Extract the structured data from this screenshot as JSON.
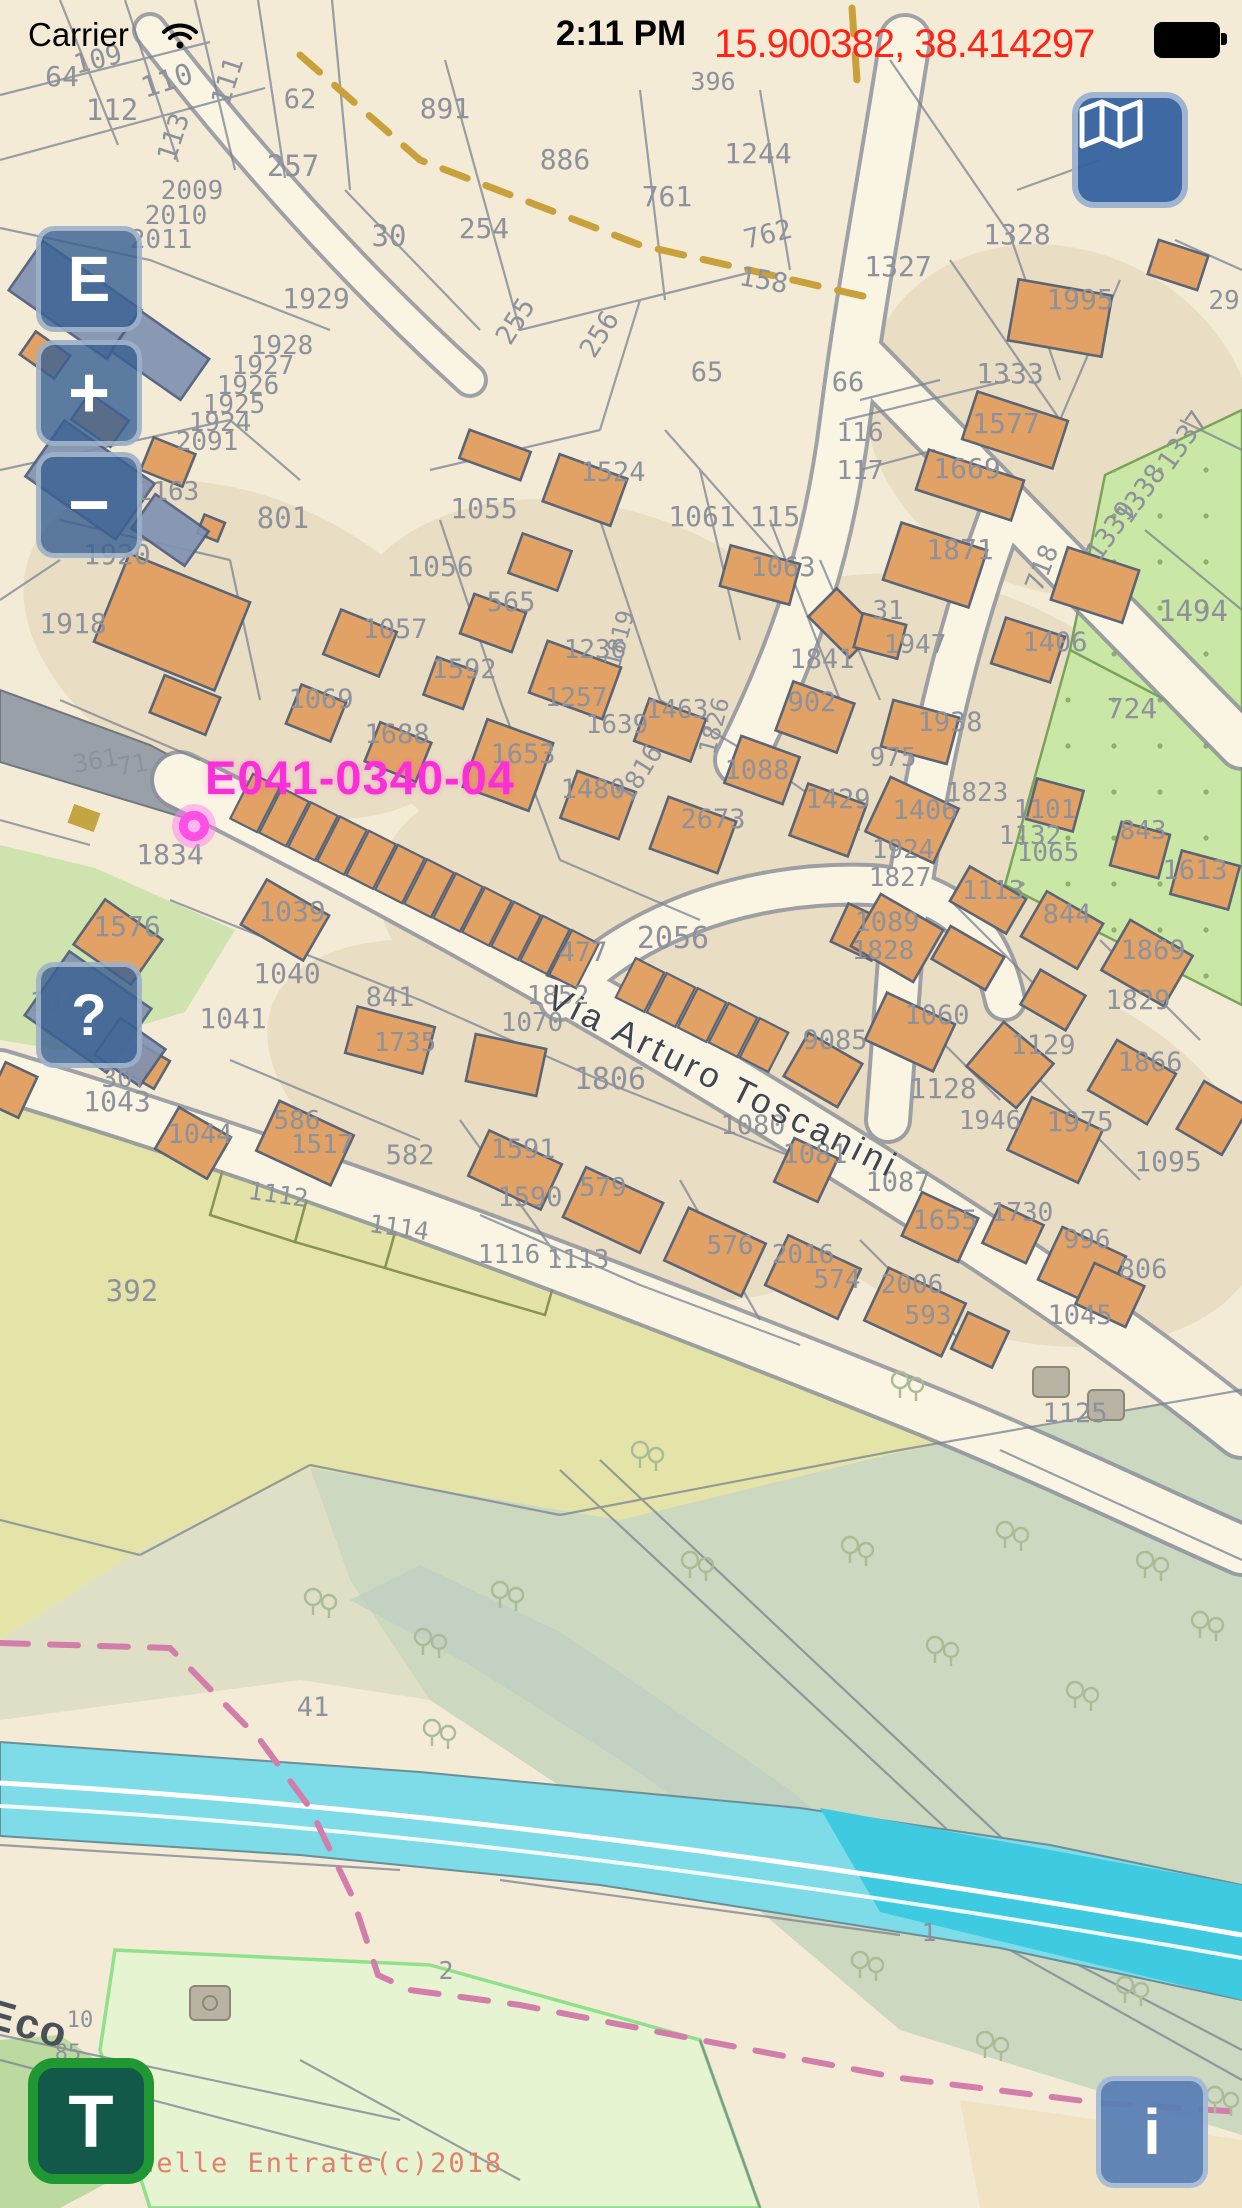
{
  "status_bar": {
    "carrier": "Carrier",
    "time": "2:11 PM"
  },
  "overlay": {
    "coordinates": "15.900382, 38.414297"
  },
  "controls": {
    "layers": {
      "name": "map-style"
    },
    "edit": {
      "label": "E"
    },
    "zoom_in": {
      "label": "+"
    },
    "zoom_out": {
      "label": "−"
    },
    "help": {
      "label": "?"
    },
    "track": {
      "label": "T"
    },
    "info": {
      "label": "i"
    }
  },
  "map": {
    "selected_parcel": "E041-0340-04",
    "street": "Via Arturo Toscanini",
    "road_label": "Eco",
    "copyright": "delle Entrate(c)2018",
    "labels": [
      {
        "t": "396",
        "x": 713,
        "y": 90,
        "s": 25
      },
      {
        "t": "64",
        "x": 62,
        "y": 86,
        "s": 28
      },
      {
        "t": "109",
        "x": 100,
        "y": 68,
        "s": 27,
        "r": -14
      },
      {
        "t": "110",
        "x": 170,
        "y": 90,
        "s": 29,
        "r": -18
      },
      {
        "t": "111",
        "x": 236,
        "y": 84,
        "s": 27,
        "r": -72
      },
      {
        "t": "112",
        "x": 112,
        "y": 120,
        "s": 29
      },
      {
        "t": "113",
        "x": 182,
        "y": 140,
        "s": 27,
        "r": -72
      },
      {
        "t": "62",
        "x": 300,
        "y": 108,
        "s": 27
      },
      {
        "t": "257",
        "x": 293,
        "y": 176,
        "s": 29
      },
      {
        "t": "30",
        "x": 389,
        "y": 246,
        "s": 29
      },
      {
        "t": "891",
        "x": 445,
        "y": 118,
        "s": 28
      },
      {
        "t": "886",
        "x": 565,
        "y": 169,
        "s": 28
      },
      {
        "t": "1244",
        "x": 758,
        "y": 163,
        "s": 28
      },
      {
        "t": "761",
        "x": 667,
        "y": 206,
        "s": 28
      },
      {
        "t": "762",
        "x": 770,
        "y": 243,
        "s": 27,
        "r": -14
      },
      {
        "t": "254",
        "x": 484,
        "y": 238,
        "s": 28
      },
      {
        "t": "255",
        "x": 523,
        "y": 326,
        "s": 27,
        "r": -58
      },
      {
        "t": "256",
        "x": 607,
        "y": 339,
        "s": 27,
        "r": -58
      },
      {
        "t": "158",
        "x": 762,
        "y": 289,
        "s": 27,
        "r": 10
      },
      {
        "t": "65",
        "x": 707,
        "y": 381,
        "s": 27
      },
      {
        "t": "66",
        "x": 848,
        "y": 391,
        "s": 27
      },
      {
        "t": "1328",
        "x": 1017,
        "y": 244,
        "s": 28
      },
      {
        "t": "1327",
        "x": 898,
        "y": 276,
        "s": 28
      },
      {
        "t": "1995",
        "x": 1080,
        "y": 309,
        "s": 28
      },
      {
        "t": "29",
        "x": 1224,
        "y": 309,
        "s": 26
      },
      {
        "t": "1333",
        "x": 1010,
        "y": 383,
        "s": 28
      },
      {
        "t": "1577",
        "x": 1006,
        "y": 433,
        "s": 28
      },
      {
        "t": "1669",
        "x": 967,
        "y": 478,
        "s": 28
      },
      {
        "t": "116",
        "x": 860,
        "y": 441,
        "s": 26
      },
      {
        "t": "117",
        "x": 860,
        "y": 479,
        "s": 26
      },
      {
        "t": "1337",
        "x": 1190,
        "y": 446,
        "s": 27,
        "r": -55
      },
      {
        "t": "1338",
        "x": 1148,
        "y": 499,
        "s": 27,
        "r": -55
      },
      {
        "t": "1339",
        "x": 1118,
        "y": 536,
        "s": 27,
        "r": -55
      },
      {
        "t": "2009",
        "x": 192,
        "y": 199,
        "s": 26
      },
      {
        "t": "2010",
        "x": 176,
        "y": 224,
        "s": 26
      },
      {
        "t": "2011",
        "x": 161,
        "y": 248,
        "s": 26
      },
      {
        "t": "1929",
        "x": 316,
        "y": 308,
        "s": 28
      },
      {
        "t": "1928",
        "x": 282,
        "y": 354,
        "s": 26
      },
      {
        "t": "1927",
        "x": 263,
        "y": 374,
        "s": 26
      },
      {
        "t": "1926",
        "x": 248,
        "y": 394,
        "s": 26
      },
      {
        "t": "1925",
        "x": 234,
        "y": 413,
        "s": 26
      },
      {
        "t": "1924",
        "x": 220,
        "y": 431,
        "s": 26
      },
      {
        "t": "2091",
        "x": 207,
        "y": 450,
        "s": 26
      },
      {
        "t": "1920",
        "x": 117,
        "y": 564,
        "s": 28
      },
      {
        "t": "1918",
        "x": 73,
        "y": 633,
        "s": 28
      },
      {
        "t": "801",
        "x": 283,
        "y": 528,
        "s": 29
      },
      {
        "t": "2163",
        "x": 168,
        "y": 500,
        "s": 26
      },
      {
        "t": "1057",
        "x": 395,
        "y": 638,
        "s": 27
      },
      {
        "t": "1069",
        "x": 321,
        "y": 708,
        "s": 27
      },
      {
        "t": "1688",
        "x": 397,
        "y": 743,
        "s": 27
      },
      {
        "t": "361",
        "x": 97,
        "y": 769,
        "s": 25,
        "r": -10
      },
      {
        "t": "71",
        "x": 134,
        "y": 773,
        "s": 25,
        "r": -10
      },
      {
        "t": "1834",
        "x": 170,
        "y": 864,
        "s": 28
      },
      {
        "t": "1524",
        "x": 613,
        "y": 481,
        "s": 27
      },
      {
        "t": "1055",
        "x": 484,
        "y": 518,
        "s": 28
      },
      {
        "t": "1056",
        "x": 440,
        "y": 576,
        "s": 28
      },
      {
        "t": "1061",
        "x": 702,
        "y": 526,
        "s": 28
      },
      {
        "t": "115",
        "x": 775,
        "y": 526,
        "s": 28
      },
      {
        "t": "1063",
        "x": 783,
        "y": 576,
        "s": 27
      },
      {
        "t": "565",
        "x": 511,
        "y": 611,
        "s": 27
      },
      {
        "t": "1592",
        "x": 464,
        "y": 678,
        "s": 27
      },
      {
        "t": "1236",
        "x": 595,
        "y": 658,
        "s": 26
      },
      {
        "t": "1257",
        "x": 576,
        "y": 706,
        "s": 26
      },
      {
        "t": "1639",
        "x": 617,
        "y": 733,
        "s": 26
      },
      {
        "t": "1463",
        "x": 677,
        "y": 718,
        "s": 26
      },
      {
        "t": "902",
        "x": 812,
        "y": 711,
        "s": 27
      },
      {
        "t": "1841",
        "x": 822,
        "y": 668,
        "s": 27
      },
      {
        "t": "1088",
        "x": 757,
        "y": 779,
        "s": 27
      },
      {
        "t": "1653",
        "x": 523,
        "y": 763,
        "s": 27
      },
      {
        "t": "1480",
        "x": 593,
        "y": 798,
        "s": 27
      },
      {
        "t": "1816",
        "x": 647,
        "y": 778,
        "s": 26,
        "r": -58
      },
      {
        "t": "1819",
        "x": 627,
        "y": 641,
        "s": 24,
        "r": -75
      },
      {
        "t": "1826",
        "x": 722,
        "y": 728,
        "s": 24,
        "r": -75
      },
      {
        "t": "1429",
        "x": 838,
        "y": 808,
        "s": 27
      },
      {
        "t": "2673",
        "x": 713,
        "y": 828,
        "s": 27
      },
      {
        "t": "1871",
        "x": 960,
        "y": 559,
        "s": 28
      },
      {
        "t": "718",
        "x": 1050,
        "y": 571,
        "s": 26,
        "r": -68
      },
      {
        "t": "1406",
        "x": 1055,
        "y": 651,
        "s": 27
      },
      {
        "t": "1494",
        "x": 1193,
        "y": 621,
        "s": 29
      },
      {
        "t": "724",
        "x": 1132,
        "y": 718,
        "s": 28
      },
      {
        "t": "31",
        "x": 888,
        "y": 619,
        "s": 26
      },
      {
        "t": "1947",
        "x": 915,
        "y": 653,
        "s": 26
      },
      {
        "t": "1938",
        "x": 950,
        "y": 731,
        "s": 27
      },
      {
        "t": "975",
        "x": 893,
        "y": 766,
        "s": 26
      },
      {
        "t": "1823",
        "x": 977,
        "y": 801,
        "s": 26
      },
      {
        "t": "1406",
        "x": 925,
        "y": 819,
        "s": 27
      },
      {
        "t": "1101",
        "x": 1045,
        "y": 818,
        "s": 26
      },
      {
        "t": "1132",
        "x": 1030,
        "y": 844,
        "s": 26
      },
      {
        "t": "1065",
        "x": 1048,
        "y": 861,
        "s": 26
      },
      {
        "t": "1924",
        "x": 903,
        "y": 858,
        "s": 26
      },
      {
        "t": "1827",
        "x": 900,
        "y": 886,
        "s": 26
      },
      {
        "t": "843",
        "x": 1143,
        "y": 839,
        "s": 26
      },
      {
        "t": "1613",
        "x": 1195,
        "y": 879,
        "s": 27
      },
      {
        "t": "1113",
        "x": 993,
        "y": 899,
        "s": 26
      },
      {
        "t": "1089",
        "x": 887,
        "y": 931,
        "s": 27
      },
      {
        "t": "1828",
        "x": 883,
        "y": 959,
        "s": 26
      },
      {
        "t": "844",
        "x": 1067,
        "y": 923,
        "s": 27
      },
      {
        "t": "1869",
        "x": 1153,
        "y": 959,
        "s": 27
      },
      {
        "t": "1829",
        "x": 1138,
        "y": 1009,
        "s": 27
      },
      {
        "t": "1060",
        "x": 937,
        "y": 1024,
        "s": 27
      },
      {
        "t": "1129",
        "x": 1043,
        "y": 1054,
        "s": 27
      },
      {
        "t": "1128",
        "x": 943,
        "y": 1098,
        "s": 28
      },
      {
        "t": "1866",
        "x": 1150,
        "y": 1071,
        "s": 27
      },
      {
        "t": "1946",
        "x": 990,
        "y": 1129,
        "s": 26
      },
      {
        "t": "1975",
        "x": 1080,
        "y": 1131,
        "s": 28
      },
      {
        "t": "1095",
        "x": 1168,
        "y": 1171,
        "s": 28
      },
      {
        "t": "1087",
        "x": 898,
        "y": 1191,
        "s": 27
      },
      {
        "t": "1655",
        "x": 945,
        "y": 1229,
        "s": 27
      },
      {
        "t": "1730",
        "x": 1022,
        "y": 1221,
        "s": 26
      },
      {
        "t": "996",
        "x": 1087,
        "y": 1248,
        "s": 26
      },
      {
        "t": "806",
        "x": 1143,
        "y": 1278,
        "s": 27
      },
      {
        "t": "2006",
        "x": 912,
        "y": 1293,
        "s": 26
      },
      {
        "t": "593",
        "x": 928,
        "y": 1324,
        "s": 26
      },
      {
        "t": "1045",
        "x": 1080,
        "y": 1324,
        "s": 27
      },
      {
        "t": "1125",
        "x": 1075,
        "y": 1422,
        "s": 27
      },
      {
        "t": "2056",
        "x": 673,
        "y": 948,
        "s": 30
      },
      {
        "t": "477",
        "x": 583,
        "y": 961,
        "s": 27
      },
      {
        "t": "1852",
        "x": 558,
        "y": 1004,
        "s": 26
      },
      {
        "t": "1070",
        "x": 532,
        "y": 1031,
        "s": 26
      },
      {
        "t": "1806",
        "x": 610,
        "y": 1089,
        "s": 30
      },
      {
        "t": "9085",
        "x": 835,
        "y": 1049,
        "s": 27
      },
      {
        "t": "1080",
        "x": 753,
        "y": 1134,
        "s": 27
      },
      {
        "t": "1081",
        "x": 815,
        "y": 1163,
        "s": 27
      },
      {
        "t": "1591",
        "x": 523,
        "y": 1158,
        "s": 27
      },
      {
        "t": "1590",
        "x": 530,
        "y": 1206,
        "s": 27
      },
      {
        "t": "579",
        "x": 603,
        "y": 1196,
        "s": 26
      },
      {
        "t": "576",
        "x": 730,
        "y": 1254,
        "s": 26
      },
      {
        "t": "574",
        "x": 837,
        "y": 1288,
        "s": 26
      },
      {
        "t": "1116",
        "x": 509,
        "y": 1263,
        "s": 26
      },
      {
        "t": "1113",
        "x": 578,
        "y": 1268,
        "s": 26
      },
      {
        "t": "2016",
        "x": 803,
        "y": 1263,
        "s": 26
      },
      {
        "t": "1576",
        "x": 127,
        "y": 936,
        "s": 28
      },
      {
        "t": "1039",
        "x": 292,
        "y": 921,
        "s": 28
      },
      {
        "t": "1040",
        "x": 287,
        "y": 983,
        "s": 28
      },
      {
        "t": "1041",
        "x": 233,
        "y": 1028,
        "s": 28
      },
      {
        "t": "1042",
        "x": 62,
        "y": 1011,
        "s": 27
      },
      {
        "t": "1043",
        "x": 117,
        "y": 1111,
        "s": 28
      },
      {
        "t": "1044",
        "x": 200,
        "y": 1143,
        "s": 27
      },
      {
        "t": "586",
        "x": 297,
        "y": 1129,
        "s": 26
      },
      {
        "t": "1517",
        "x": 322,
        "y": 1153,
        "s": 26
      },
      {
        "t": "841",
        "x": 390,
        "y": 1006,
        "s": 27
      },
      {
        "t": "1735",
        "x": 405,
        "y": 1051,
        "s": 26
      },
      {
        "t": "307",
        "x": 125,
        "y": 1087,
        "s": 26
      },
      {
        "t": "582",
        "x": 410,
        "y": 1164,
        "s": 27
      },
      {
        "t": "1112",
        "x": 277,
        "y": 1203,
        "s": 25,
        "r": 8
      },
      {
        "t": "1114",
        "x": 398,
        "y": 1236,
        "s": 25,
        "r": 8
      },
      {
        "t": "392",
        "x": 132,
        "y": 1301,
        "s": 29
      },
      {
        "t": "41",
        "x": 313,
        "y": 1716,
        "s": 27
      },
      {
        "t": "1",
        "x": 929,
        "y": 1941,
        "s": 25
      },
      {
        "t": "2",
        "x": 446,
        "y": 1979,
        "s": 25
      },
      {
        "t": "10",
        "x": 80,
        "y": 2027,
        "s": 22
      },
      {
        "t": "85",
        "x": 68,
        "y": 2060,
        "s": 22
      }
    ]
  }
}
